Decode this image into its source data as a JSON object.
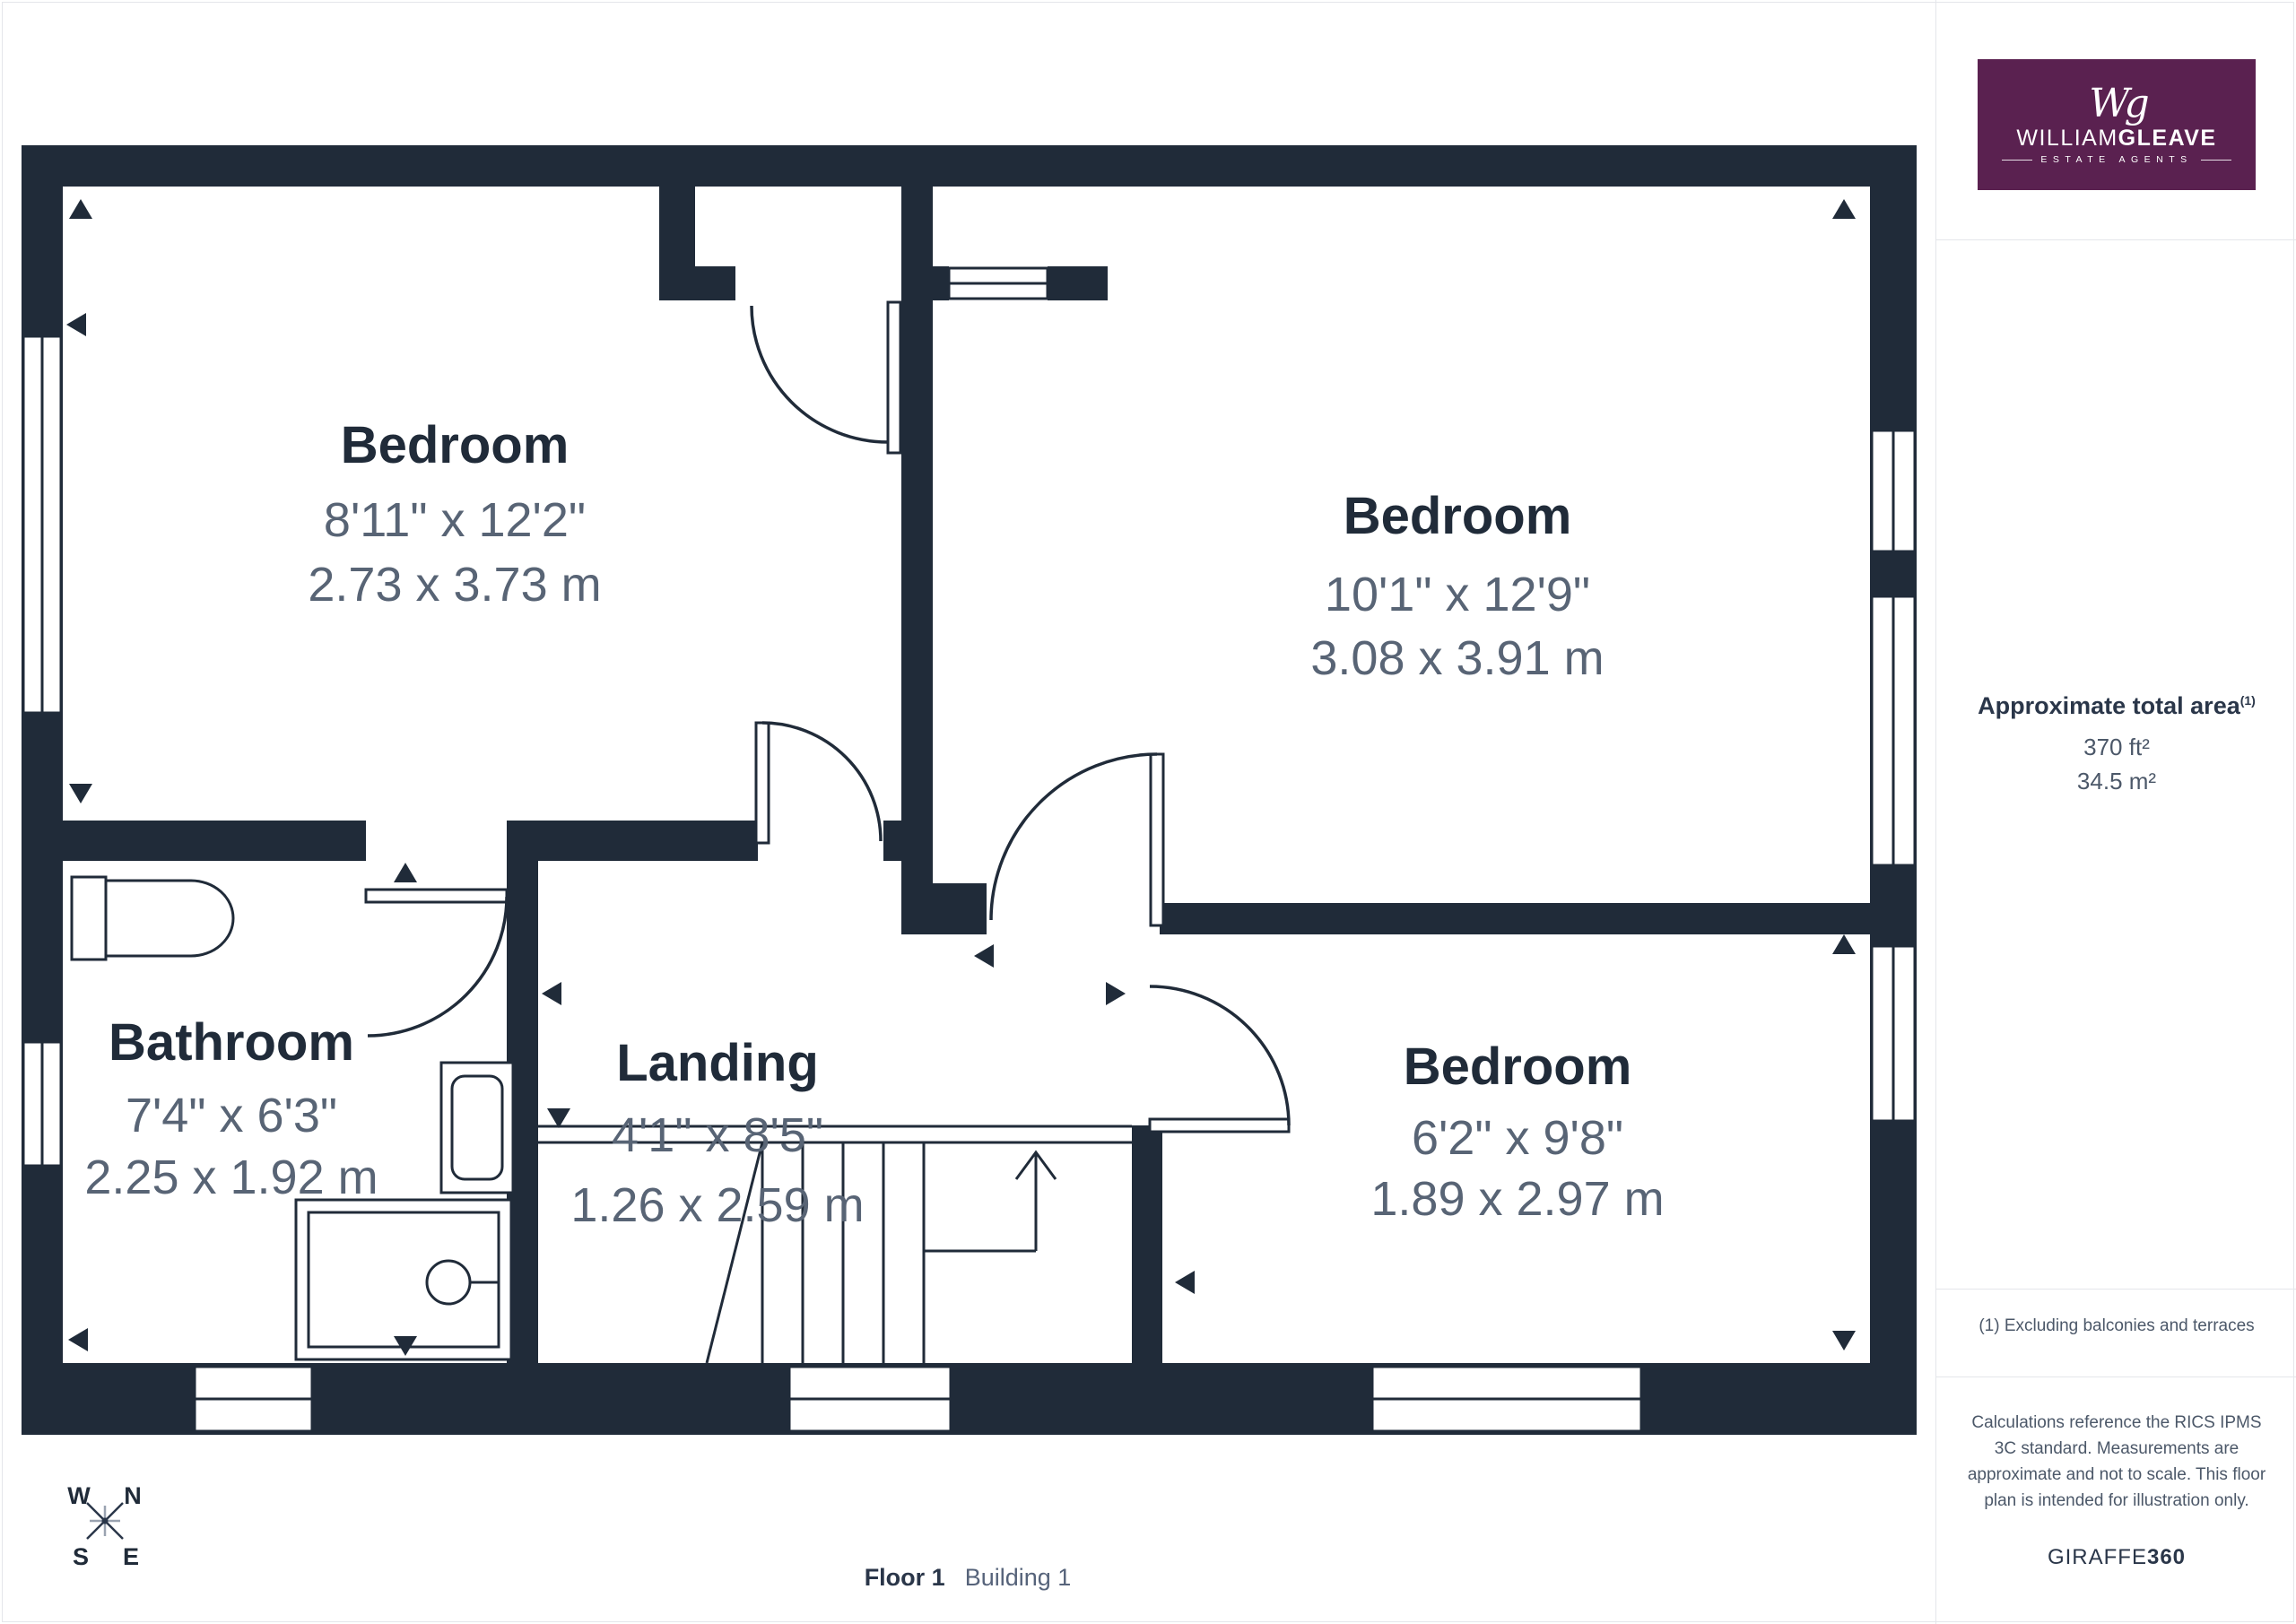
{
  "colors": {
    "wall": "#202B39",
    "dim_text": "#586475",
    "logo_bg": "#5A2150",
    "sidebar_text": "#4C5869",
    "heading_text": "#2A3649",
    "border": "#E4E6EA"
  },
  "logo": {
    "monogram": "Wg",
    "name_regular": "WILLIAM",
    "name_bold": "GLEAVE",
    "tagline": "ESTATE AGENTS"
  },
  "sidebar": {
    "area_heading": "Approximate total area",
    "area_heading_sup": "(1)",
    "area_imperial": "370 ft²",
    "area_metric": "34.5 m²",
    "footnote": "(1) Excluding balconies and terraces",
    "disclaimer": "Calculations reference the RICS IPMS 3C standard. Measurements are approximate and not to scale. This floor plan is intended for illustration only.",
    "brand_regular": "GIRAFFE",
    "brand_bold": "360"
  },
  "rooms": [
    {
      "name": "Bedroom",
      "imperial": "8'11\" x 12'2\"",
      "metric": "2.73 x 3.73 m"
    },
    {
      "name": "Bedroom",
      "imperial": "10'1\" x 12'9\"",
      "metric": "3.08 x 3.91 m"
    },
    {
      "name": "Bathroom",
      "imperial": "7'4\" x 6'3\"",
      "metric": "2.25 x 1.92 m"
    },
    {
      "name": "Landing",
      "imperial": "4'1\" x 8'5\"",
      "metric": "1.26 x 2.59 m"
    },
    {
      "name": "Bedroom",
      "imperial": "6'2\" x 9'8\"",
      "metric": "1.89 x 2.97 m"
    }
  ],
  "compass": {
    "west": "W",
    "north": "N",
    "south": "S",
    "east": "E"
  },
  "footer": {
    "floor": "Floor 1",
    "building": "Building 1"
  }
}
